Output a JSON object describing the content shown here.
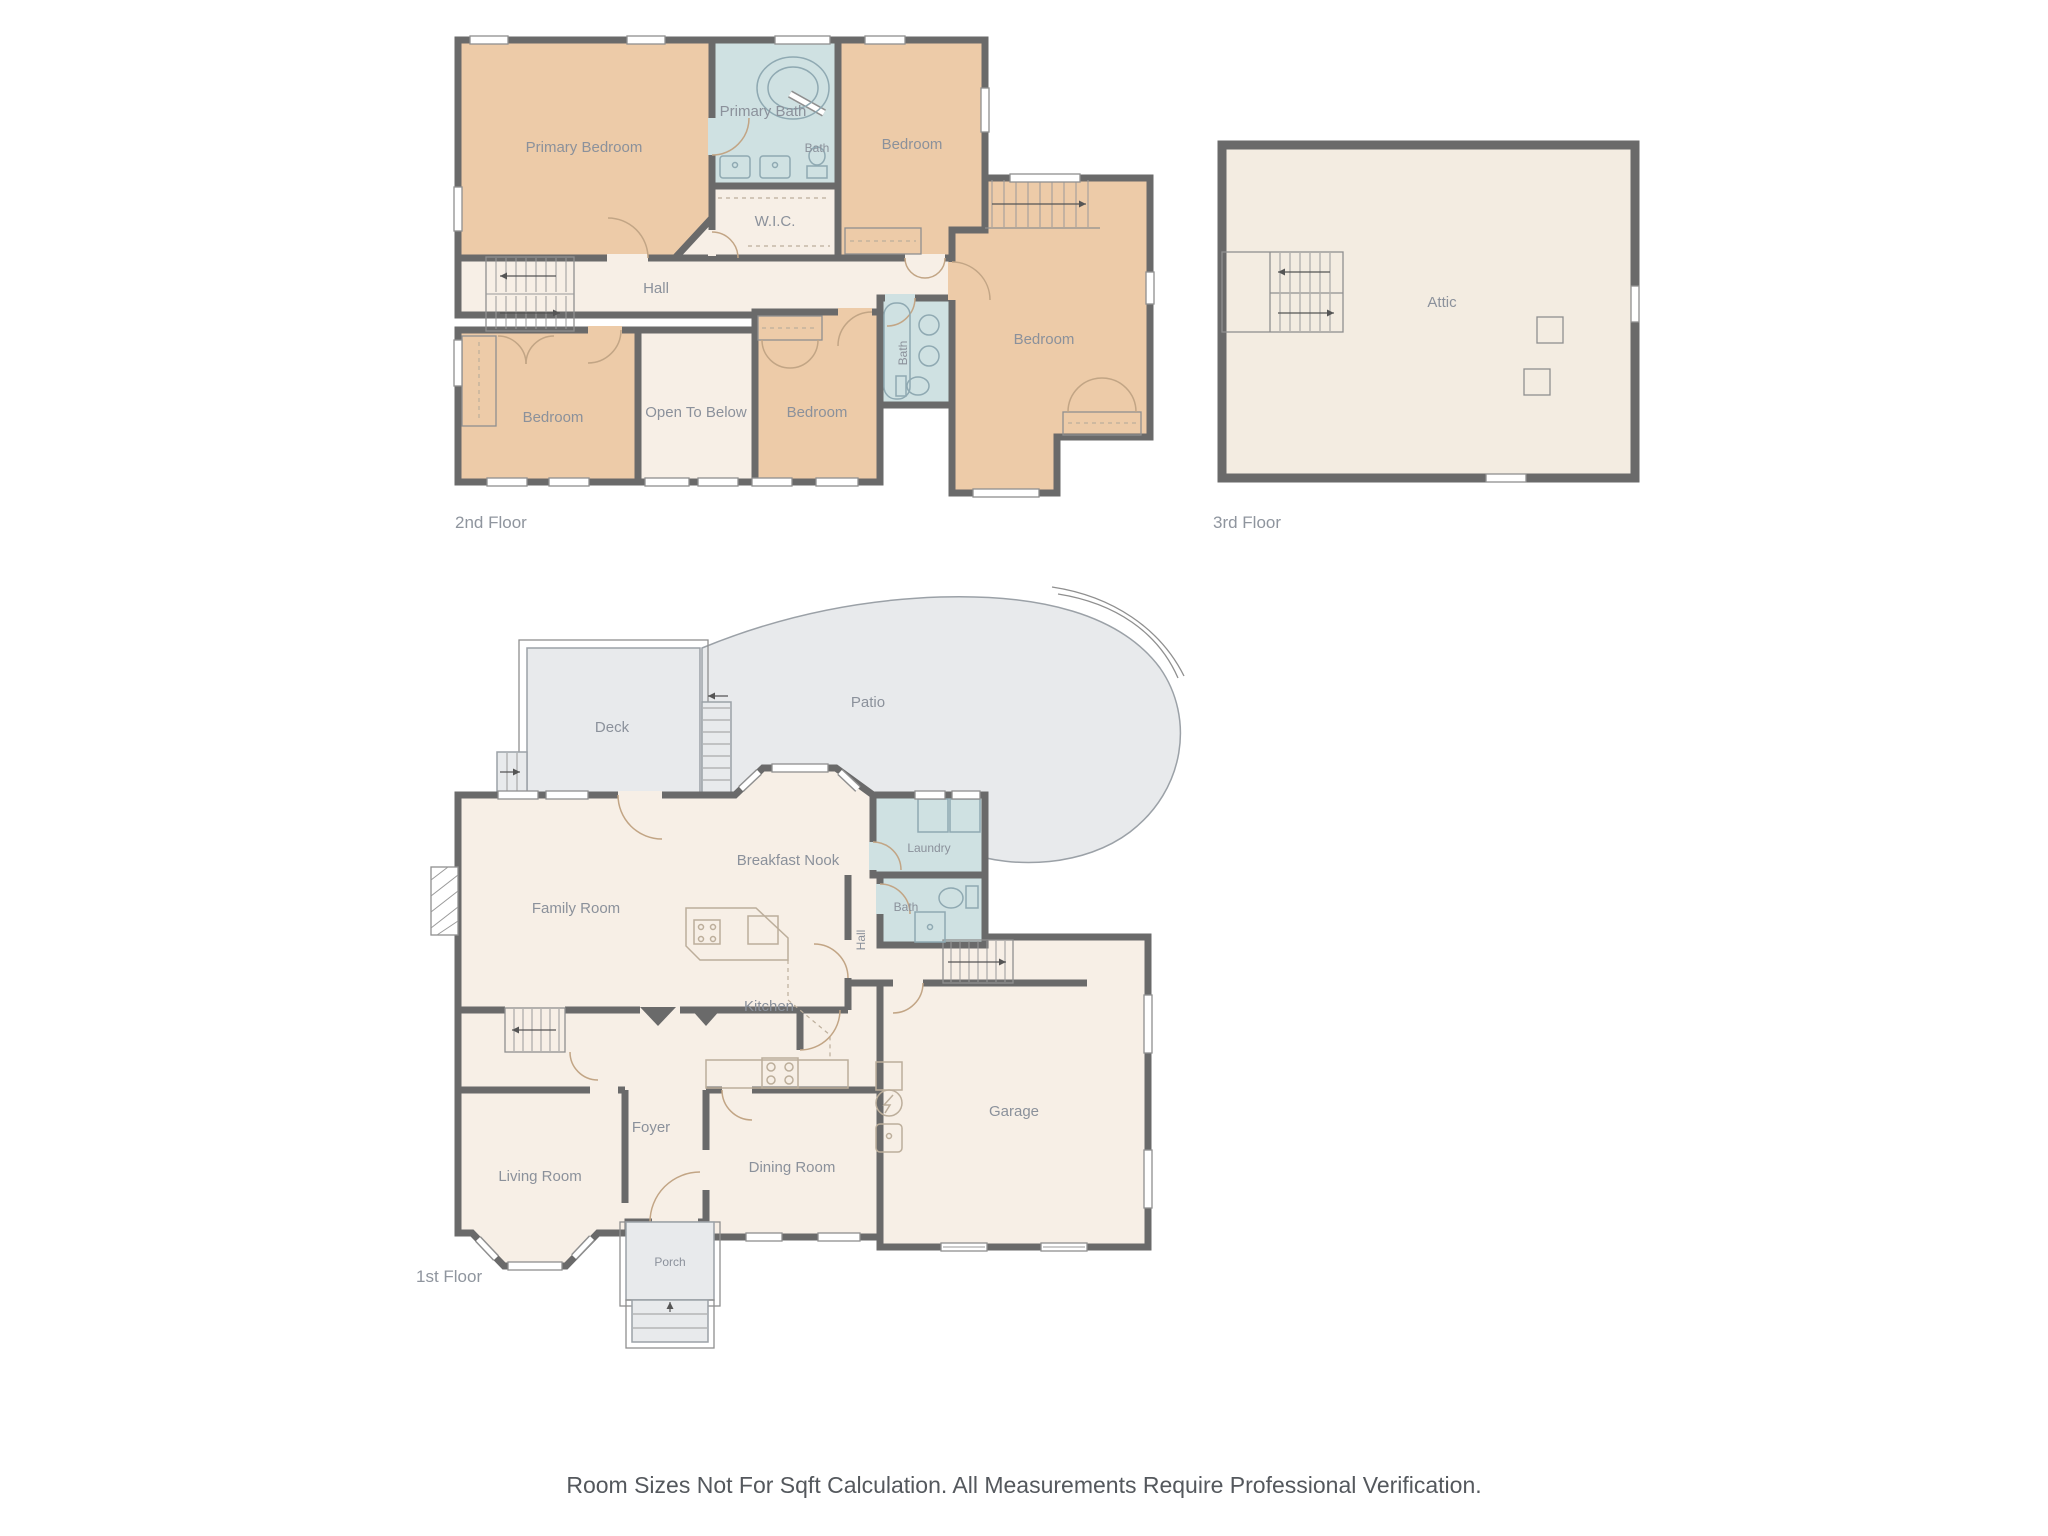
{
  "colors": {
    "wall": "#6a6a6a",
    "bedroom_fill": "#edcba8",
    "bath_fill": "#cfe1e2",
    "interior_fill": "#f7efe6",
    "attic_fill": "#f3ece1",
    "outdoor_fill": "#e8eaec",
    "label_text": "#8b919b",
    "disclaimer_text": "#54585d"
  },
  "floors": {
    "f2": {
      "name": "2nd Floor",
      "rooms": {
        "primary_bedroom": "Primary Bedroom",
        "primary_bath": "Primary Bath",
        "bath_small": "Bath",
        "wic": "W.I.C.",
        "hall": "Hall",
        "bedroom_ne": "Bedroom",
        "bedroom_sw": "Bedroom",
        "open_below": "Open To Below",
        "bedroom_s": "Bedroom",
        "bath": "Bath",
        "bedroom_e": "Bedroom"
      }
    },
    "f3": {
      "name": "3rd Floor",
      "rooms": {
        "attic": "Attic"
      }
    },
    "f1": {
      "name": "1st Floor",
      "rooms": {
        "deck": "Deck",
        "patio": "Patio",
        "breakfast_nook": "Breakfast Nook",
        "laundry": "Laundry",
        "bath": "Bath",
        "hall": "Hall",
        "family_room": "Family Room",
        "kitchen": "Kitchen",
        "foyer": "Foyer",
        "living_room": "Living Room",
        "dining_room": "Dining Room",
        "porch": "Porch",
        "garage": "Garage"
      }
    }
  },
  "footer": {
    "disclaimer": "Room Sizes Not For Sqft Calculation. All Measurements Require Professional Verification."
  }
}
